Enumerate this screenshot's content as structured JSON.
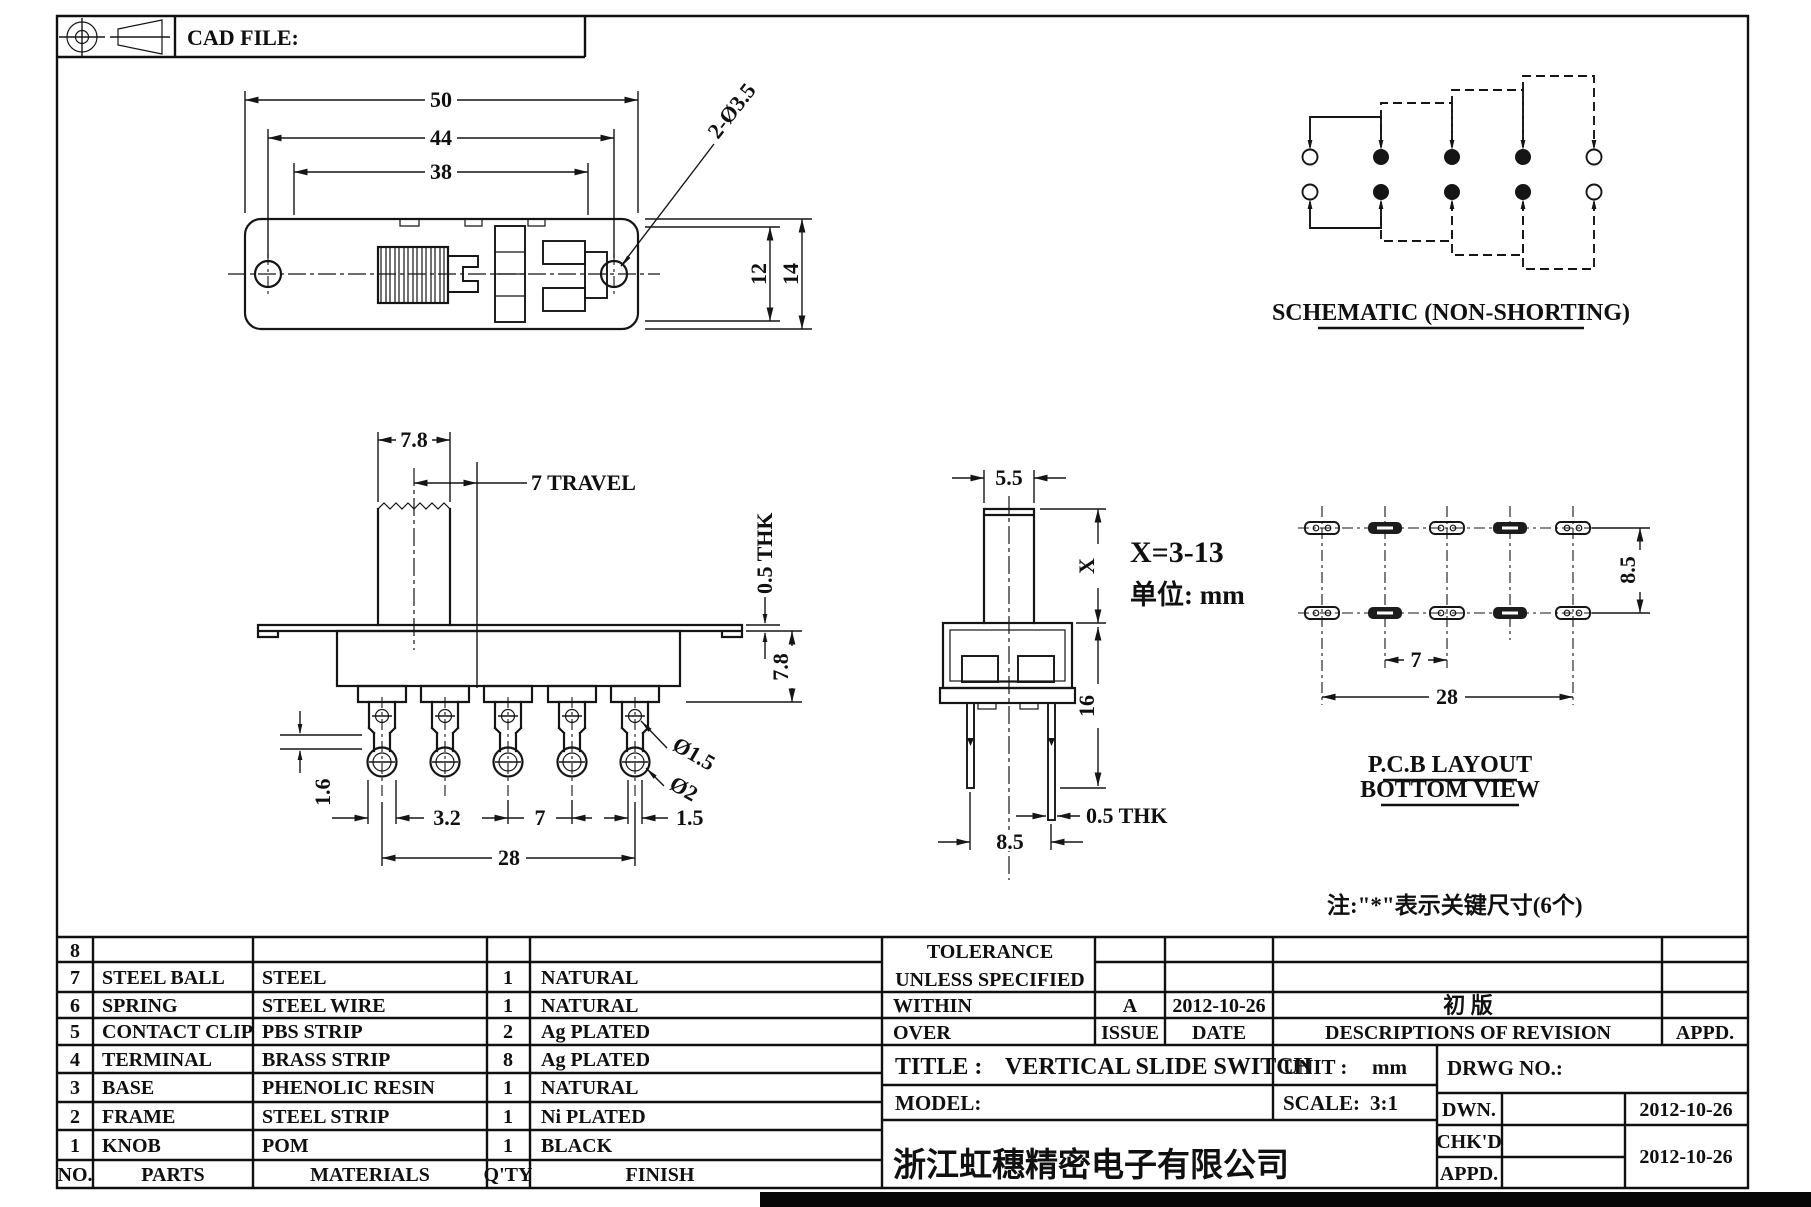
{
  "sheet": {
    "cad_file_label": "CAD FILE:",
    "note": "注:\"*\"表示关键尺寸(6个)"
  },
  "top_view": {
    "dim_50": "50",
    "dim_44": "44",
    "dim_38": "38",
    "dim_holes": "2-Ø3.5",
    "dim_12": "12",
    "dim_14": "14"
  },
  "schematic": {
    "caption": "SCHEMATIC (NON-SHORTING)"
  },
  "front_view": {
    "dim_knob_width": "7.8",
    "dim_travel": "7 TRAVEL",
    "dim_frame_thk": "0.5 THK",
    "dim_body_height": "7.8",
    "dim_1_6": "1.6",
    "dim_3_2": "3.2",
    "dim_7": "7",
    "dim_1_5": "1.5",
    "dim_28": "28",
    "dim_hole_small": "Ø1.5",
    "dim_hole_big": "Ø2"
  },
  "side_view": {
    "dim_5_5": "5.5",
    "dim_x": "X",
    "x_range": "X=3-13",
    "unit_note": "单位: mm",
    "dim_16": "16",
    "dim_pin_thk": "0.5 THK",
    "dim_8_5": "8.5"
  },
  "pcb_view": {
    "caption_line1": "P.C.B LAYOUT",
    "caption_line2": "BOTTOM VIEW",
    "dim_8_5": "8.5",
    "dim_7": "7",
    "dim_28": "28"
  },
  "parts_table": {
    "header": {
      "no": "NO.",
      "parts": "PARTS",
      "materials": "MATERIALS",
      "qty": "Q'TY",
      "finish": "FINISH"
    },
    "rows": [
      {
        "no": "8",
        "part": "",
        "material": "",
        "qty": "",
        "finish": ""
      },
      {
        "no": "7",
        "part": "STEEL BALL",
        "material": "STEEL",
        "qty": "1",
        "finish": "NATURAL"
      },
      {
        "no": "6",
        "part": "SPRING",
        "material": "STEEL WIRE",
        "qty": "1",
        "finish": "NATURAL"
      },
      {
        "no": "5",
        "part": "CONTACT CLIP",
        "material": "PBS STRIP",
        "qty": "2",
        "finish": "Ag PLATED"
      },
      {
        "no": "4",
        "part": "TERMINAL",
        "material": "BRASS STRIP",
        "qty": "8",
        "finish": "Ag PLATED"
      },
      {
        "no": "3",
        "part": "BASE",
        "material": "PHENOLIC RESIN",
        "qty": "1",
        "finish": "NATURAL"
      },
      {
        "no": "2",
        "part": "FRAME",
        "material": "STEEL STRIP",
        "qty": "1",
        "finish": "Ni PLATED"
      },
      {
        "no": "1",
        "part": "KNOB",
        "material": "POM",
        "qty": "1",
        "finish": "BLACK"
      }
    ]
  },
  "title_block": {
    "tolerance_line1": "TOLERANCE",
    "tolerance_line2": "UNLESS SPECIFIED",
    "within_label": "WITHIN",
    "over_label": "OVER",
    "issue_value": "A",
    "issue_label": "ISSUE",
    "date_value": "2012-10-26",
    "date_label": "DATE",
    "revision_value": "初 版",
    "revision_label": "DESCRIPTIONS OF REVISION",
    "appd_col_label": "APPD.",
    "title_label": "TITLE :",
    "title_value": "VERTICAL SLIDE SWITCH",
    "unit_label": "UNIT :",
    "unit_value": "mm",
    "drwg_label": "DRWG NO.:",
    "model_label": "MODEL:",
    "scale_label": "SCALE:",
    "scale_value": "3:1",
    "dwn_label": "DWN.",
    "dwn_date": "2012-10-26",
    "chkd_label": "CHK'D",
    "appd_label": "APPD.",
    "chkd_appd_date": "2012-10-26",
    "company": "浙江虹穗精密电子有限公司"
  }
}
